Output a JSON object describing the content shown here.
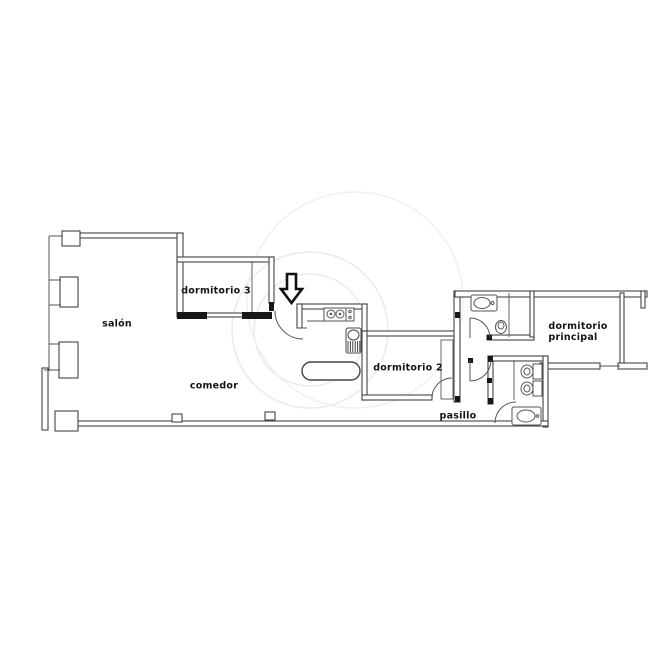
{
  "plan": {
    "type": "apartment-floor-plan",
    "rooms": {
      "salon": "salón",
      "dormitorio3": "dormitorio 3",
      "comedor": "comedor",
      "dormitorio2": "dormitorio 2",
      "pasillo": "pasillo",
      "principal_line1": "dormitorio",
      "principal_line2": "principal"
    },
    "icons": {
      "entrance_arrow": "down-arrow"
    },
    "colors": {
      "line": "#444444",
      "heavy_line": "#2f2f2f",
      "solid_wall": "#161616",
      "wall_fill": "#ffffff",
      "label": "#141414",
      "watermark": "#eaeaea",
      "background": "#ffffff"
    }
  }
}
